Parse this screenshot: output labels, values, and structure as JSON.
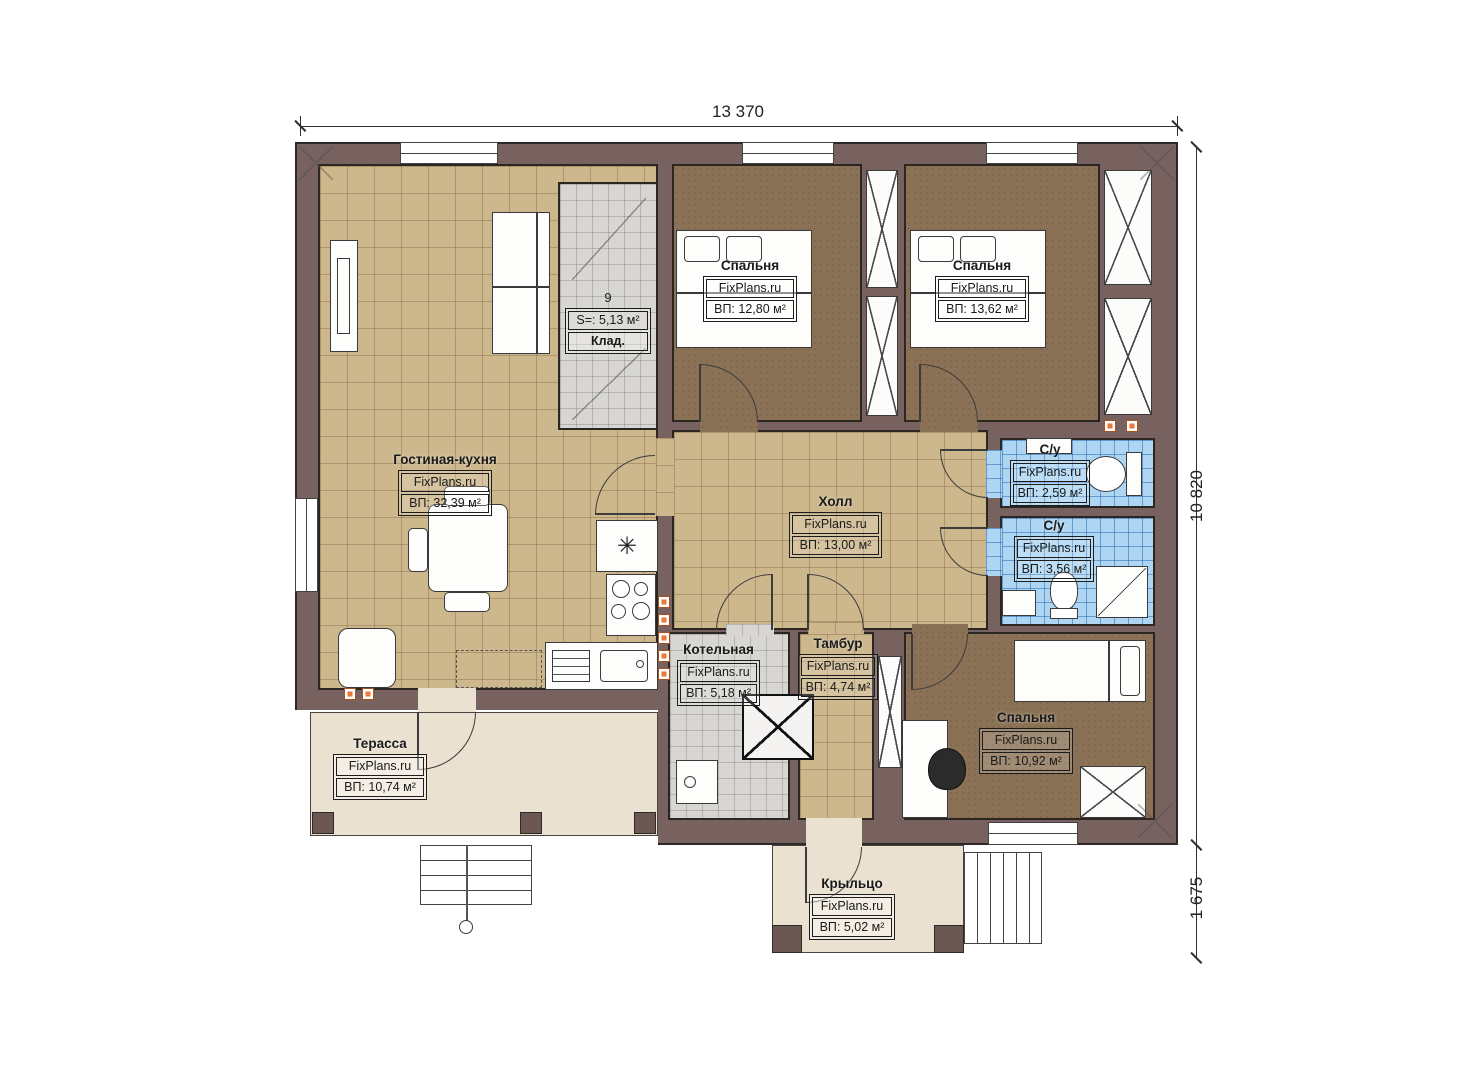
{
  "dimensions": {
    "top": "13 370",
    "right": "10 820",
    "porch": "1 675"
  },
  "rooms": {
    "living": {
      "name": "Гостиная-кухня",
      "brand": "FixPlans.ru",
      "area": "ВП: 32,39 м²"
    },
    "storage": {
      "number": "9",
      "area": "S=: 5,13 м²",
      "name": "Клад."
    },
    "bedroom1": {
      "name": "Спальня",
      "brand": "FixPlans.ru",
      "area": "ВП: 12,80 м²"
    },
    "bedroom2": {
      "name": "Спальня",
      "brand": "FixPlans.ru",
      "area": "ВП: 13,62 м²"
    },
    "hall": {
      "name": "Холл",
      "brand": "FixPlans.ru",
      "area": "ВП: 13,00 м²"
    },
    "bath1": {
      "name": "С/у",
      "brand": "FixPlans.ru",
      "area": "ВП: 2,59 м²"
    },
    "bath2": {
      "name": "С/у",
      "brand": "FixPlans.ru",
      "area": "ВП: 3,56 м²"
    },
    "boiler": {
      "name": "Котельная",
      "brand": "FixPlans.ru",
      "area": "ВП: 5,18 м²"
    },
    "tambour": {
      "name": "Тамбур",
      "brand": "FixPlans.ru",
      "area": "ВП: 4,74 м²"
    },
    "bedroom3": {
      "name": "Спальня",
      "brand": "FixPlans.ru",
      "area": "ВП: 10,92 м²"
    },
    "terrace": {
      "name": "Терасса",
      "brand": "FixPlans.ru",
      "area": "ВП: 10,74 м²"
    },
    "porch": {
      "name": "Крыльцо",
      "brand": "FixPlans.ru",
      "area": "ВП: 5,02 м²"
    }
  },
  "symbols": {
    "heater": "✳"
  },
  "colors": {
    "wall": "#786260",
    "floor_beige": "#cdb78d",
    "floor_brown": "#8b7256",
    "floor_blue": "#aed6f2",
    "floor_gray": "#d8d6d2",
    "floor_light": "#ebe1d1",
    "accent_orange": "#e8793a"
  }
}
